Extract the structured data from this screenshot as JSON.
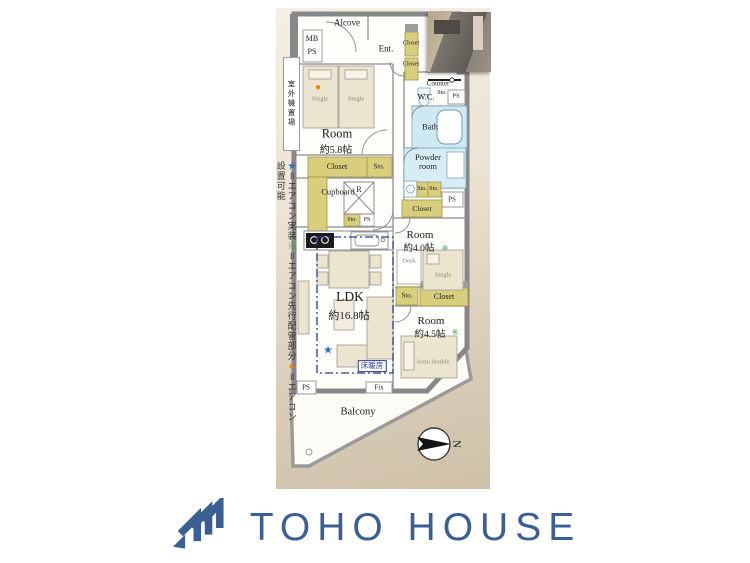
{
  "floorplan": {
    "labels": {
      "alcove": "Alcove",
      "mb": "MB",
      "ps": "PS",
      "ent": "Ent.",
      "closet": "Closet",
      "sto": "Sto.",
      "outdoor_unit": "室外機置場",
      "counter": "Counter",
      "wc": "W.C.",
      "bath": "Bath",
      "powder_room": "Powder room",
      "single": "Single",
      "room": "Room",
      "room58_size": "約5.8帖",
      "cupboard": "Cupboard",
      "fridge": "R",
      "room40_size": "約4.0帖",
      "desk": "Desk",
      "ldk": "LDK",
      "ldk_size": "約16.8帖",
      "floor_heating": "床暖房",
      "room45_size": "約4.5帖",
      "semi_double": "Semi double",
      "balcony": "Balcony",
      "fix": "Fix",
      "north": "N"
    },
    "markers": {
      "star": "★",
      "pipe": "※",
      "dot": "●"
    },
    "legend": {
      "items": [
        {
          "symbol": "★",
          "color": "#2f6eb6",
          "text": "＝エアコン実装"
        },
        {
          "symbol": "※",
          "color": "#3f9d4b",
          "text": "＝エアコン先行配管部分"
        },
        {
          "symbol": "●",
          "color": "#ef8200",
          "text": "＝エアコン設置可能"
        }
      ]
    },
    "colors": {
      "wall_gray": "#878787",
      "storage_yellow": "#d8ce7c",
      "wet_blue": "#cfe9f2",
      "furniture_cream": "#ebe4cf",
      "bg_beige_top": "#f4efe6",
      "bg_beige_bottom": "#cec0a8",
      "heating_navy": "#2c3a8c"
    }
  },
  "footer": {
    "brand": "TOHO HOUSE",
    "brand_color": "#3a5f94"
  }
}
